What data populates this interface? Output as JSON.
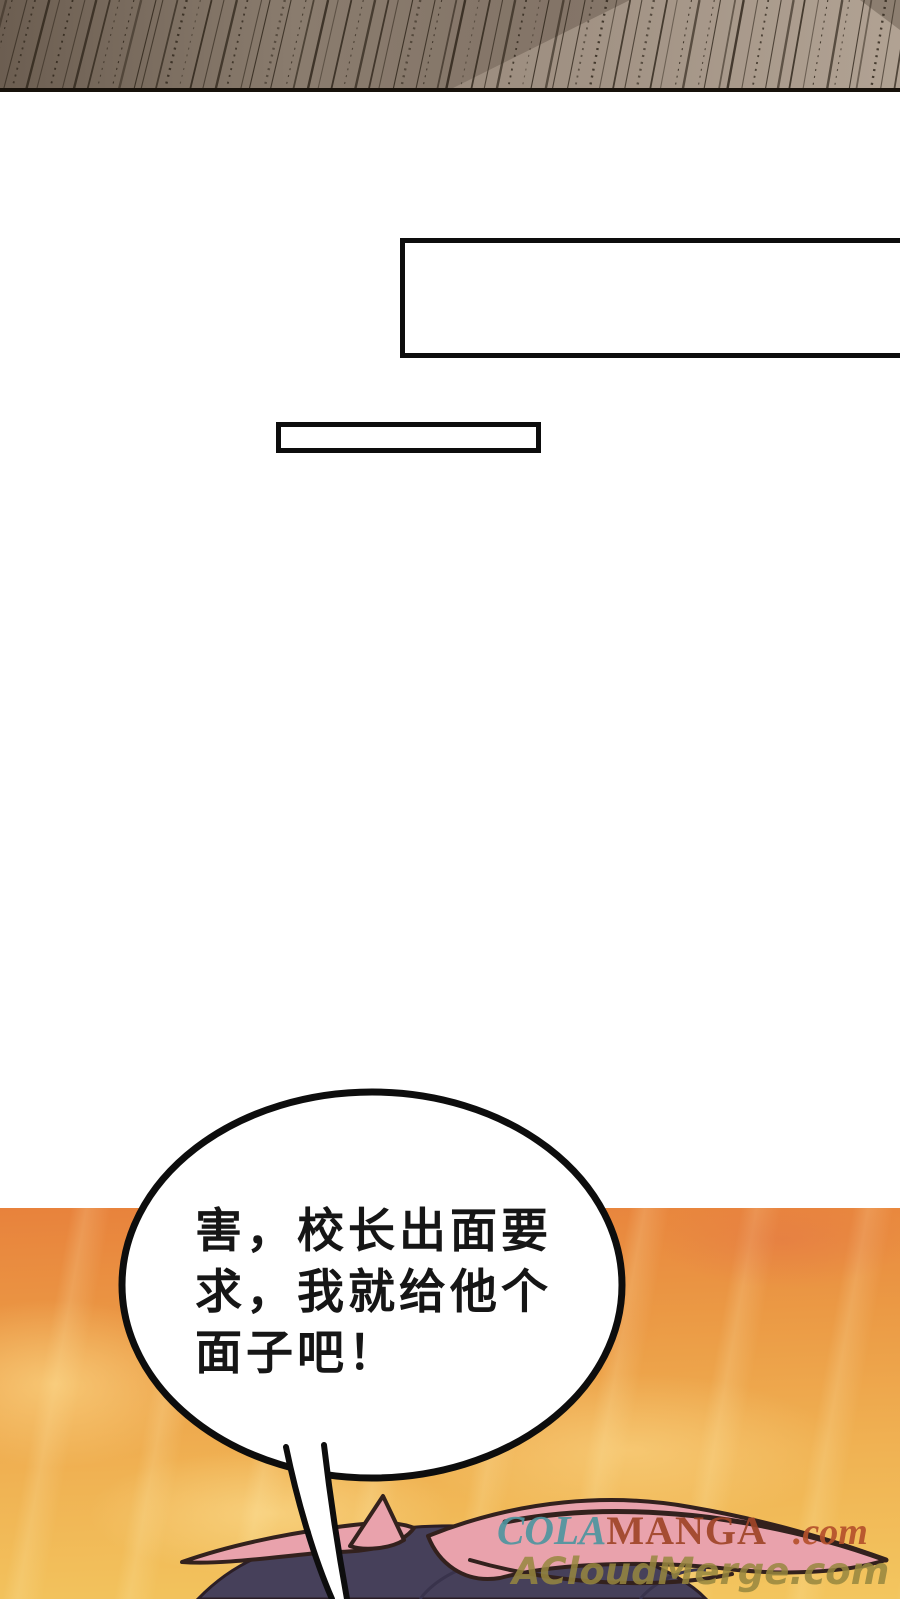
{
  "page_type": "manga-webtoon-page",
  "bubble": {
    "lines": [
      "害，校长出面要",
      "求，我就给他个",
      "面子吧！"
    ]
  },
  "caption_boxes": [
    "",
    ""
  ],
  "watermarks": {
    "colamanga": {
      "cola": "COLA",
      "manga": "MANGA",
      "dotcom": ".com",
      "cola_color": "#4f95a0",
      "manga_color": "#a04528",
      "dotcom_color": "#b5512c"
    },
    "acloudmerge": {
      "text": "ACloudMerge.com",
      "color": "#97873f"
    }
  },
  "colors": {
    "page_background": "#ffffff",
    "orange_panel_top": "#e8823c",
    "orange_panel_bottom": "#f3c65f",
    "wood_panel_base": "#87796b",
    "wood_panel_light_band": "#a89a8b",
    "wood_panel_lines": "#2b2217",
    "hair_dark": "#46405a",
    "hair_pink": "#e9a2ac",
    "art_outline": "#33211d",
    "bubble_border": "#0d0d0d"
  }
}
